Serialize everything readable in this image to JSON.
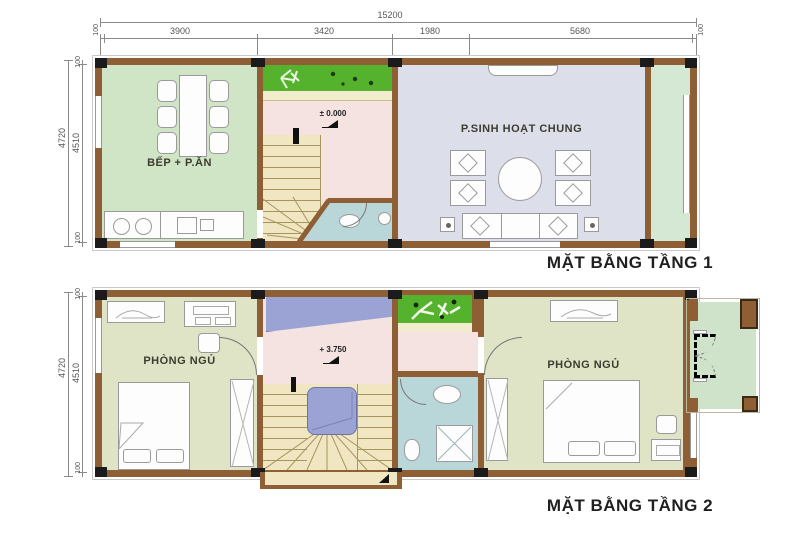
{
  "colors": {
    "wall": "#8e5f35",
    "column": "#1b1b1b",
    "kitchen": "#cfe5c6",
    "living": "#dcdfe9",
    "hall": "#f4e3e1",
    "stair": "#f0e6c2",
    "step": "#a8945f",
    "garden": "#54b22c",
    "trim": "#f2ecce",
    "bath": "#b9d6d9",
    "bedroom": "#dfe4c6",
    "voidp": "#9aa3d4",
    "balcony": "#cfe3cb",
    "dimline": "#8a8a8a",
    "dimtext": "#555555",
    "label": "#3c3c30",
    "furn": "#fdfdfd",
    "furnline": "#9a9a9a",
    "title": "#1f1f1f"
  },
  "dims_top": {
    "total": "15200",
    "e1": "100",
    "s1": "3900",
    "s2": "3420",
    "s3": "1980",
    "s4": "5680",
    "e2": "100"
  },
  "floor1": {
    "title": "MẶT BẰNG TẦNG 1",
    "dim_total": "4720",
    "dim_inner": "4510",
    "dim_e_top": "100",
    "dim_e_bottom": "100",
    "kitchen_label": "BẾP + P.ĂN",
    "living_label": "P.SINH HOẠT CHUNG",
    "level": "± 0.000"
  },
  "floor2": {
    "title": "MẶT BẰNG TẦNG 2",
    "dim_total": "4720",
    "dim_inner": "4510",
    "dim_e_top": "100",
    "dim_e_bottom": "100",
    "bedroom_left_label": "PHÒNG NGỦ",
    "bedroom_right_label": "PHÒNG NGỦ",
    "level": "+ 3.750"
  }
}
